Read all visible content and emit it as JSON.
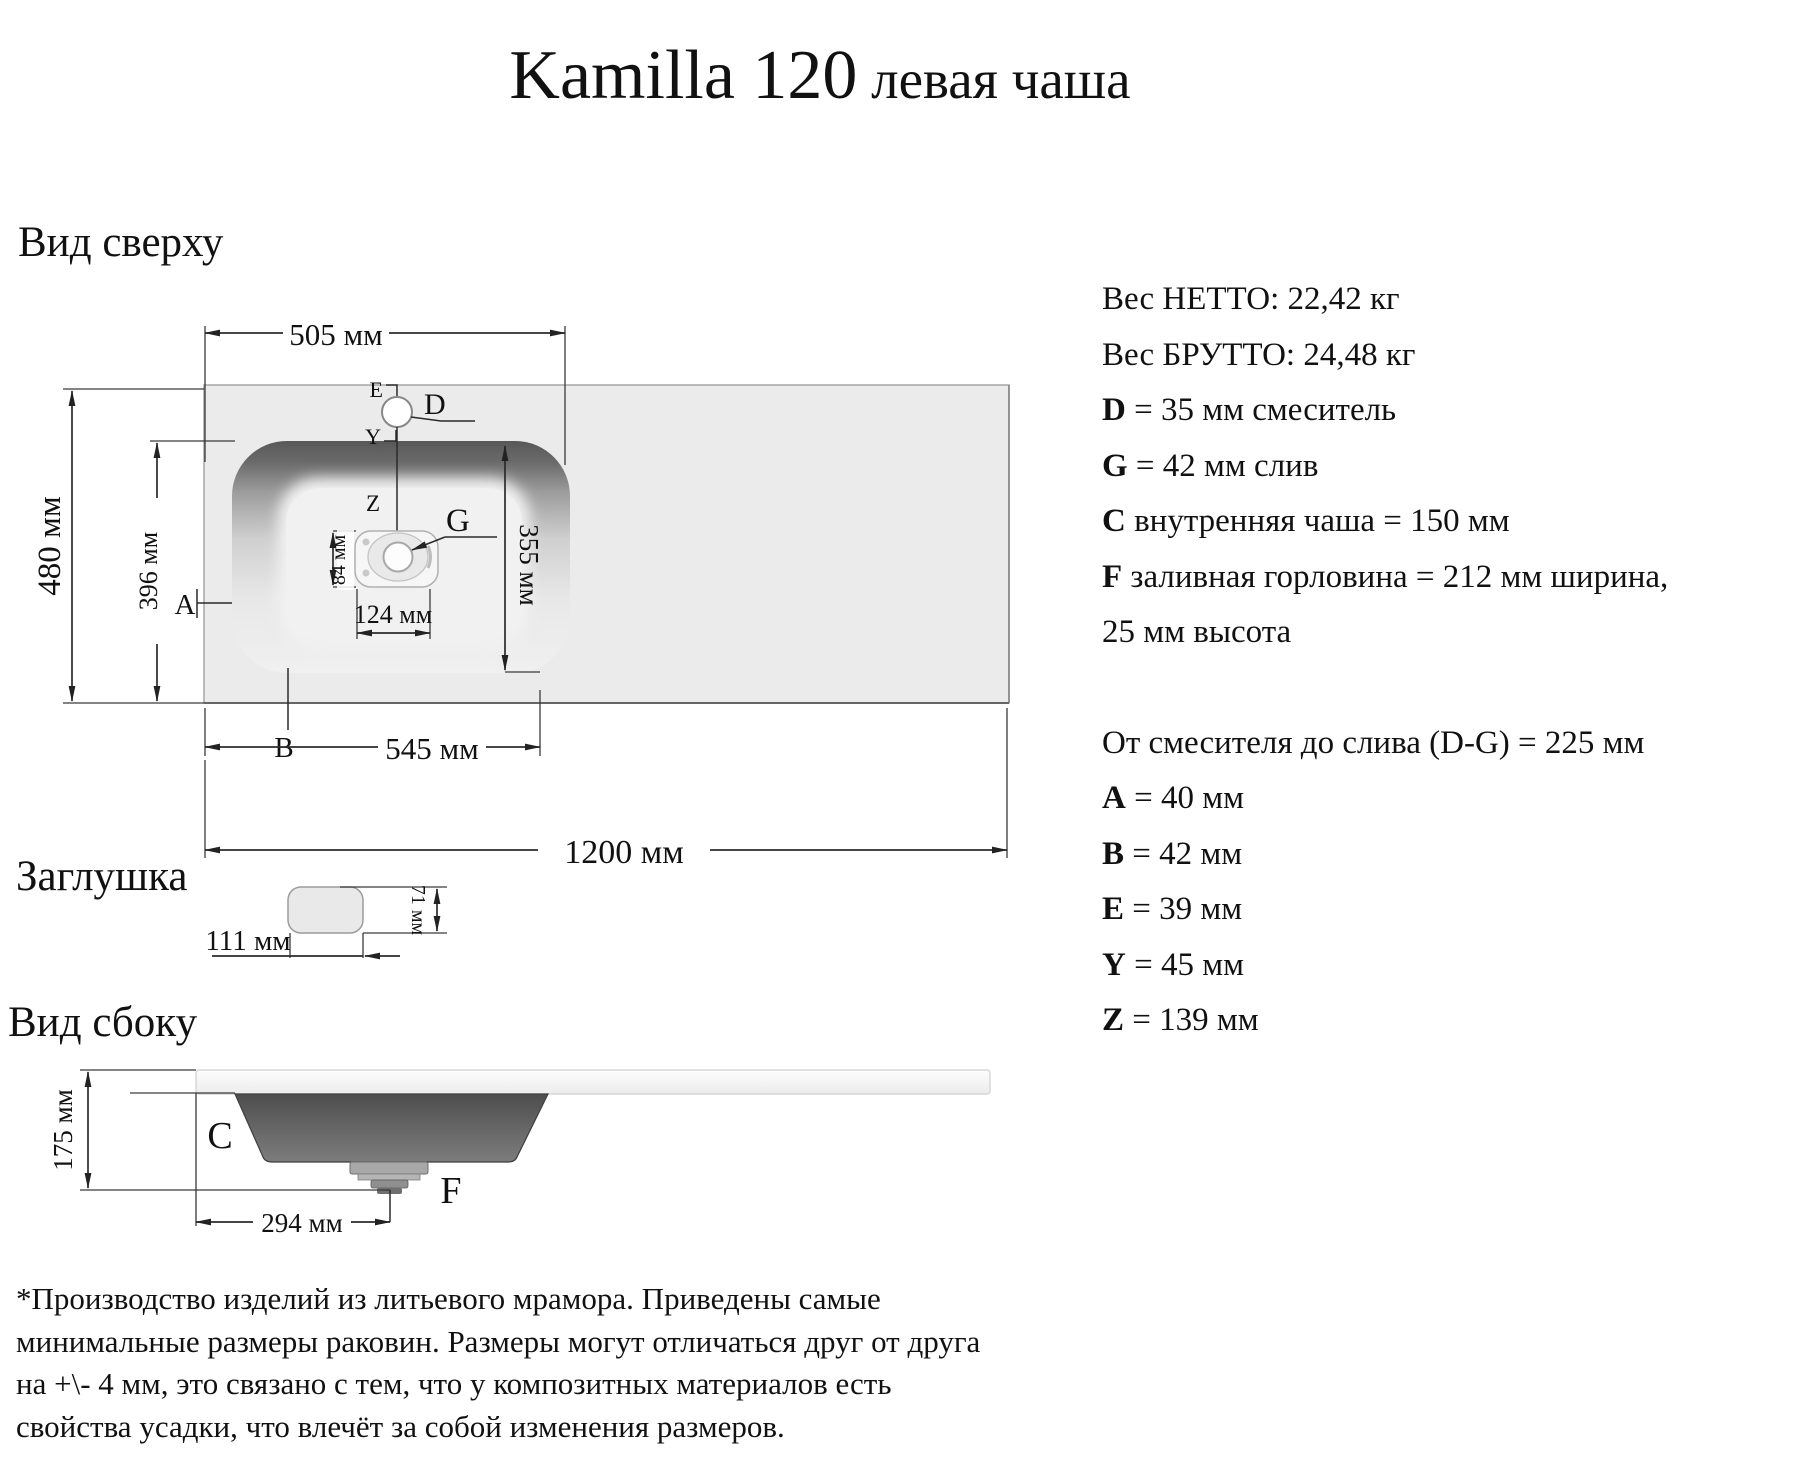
{
  "title": {
    "main": "Kamilla 120",
    "sub": " левая чаша"
  },
  "sections": {
    "top_view": "Вид сверху",
    "plug": "Заглушка",
    "side_view": "Вид сбоку"
  },
  "top_view": {
    "dim_505": "505 мм",
    "dim_480": "480 мм",
    "dim_396": "396 мм",
    "dim_355": "355 мм",
    "dim_84": "84 мм",
    "dim_124": "124 мм",
    "dim_545": "545 мм",
    "dim_1200": "1200 мм",
    "label_a": "A",
    "label_b": "B",
    "label_d": "D",
    "label_e": "E",
    "label_y": "Y",
    "label_z": "Z",
    "label_g": "G"
  },
  "plug": {
    "dim_width": "111 мм",
    "dim_height": "71 мм"
  },
  "side_view": {
    "dim_175": "175 мм",
    "dim_294": "294 мм",
    "label_c": "C",
    "label_f": "F"
  },
  "specs": [
    {
      "prefix": "",
      "rest": "Вес НЕТТО: 22,42 кг"
    },
    {
      "prefix": "",
      "rest": "Вес БРУТТО: 24,48 кг"
    },
    {
      "prefix": "D",
      "rest": " = 35 мм смеситель"
    },
    {
      "prefix": "G",
      "rest": " = 42 мм слив"
    },
    {
      "prefix": "C",
      "rest": " внутренняя чаша = 150 мм"
    },
    {
      "prefix": "F",
      "rest": " заливная горловина = 212 мм ширина,"
    },
    {
      "prefix": "",
      "rest": "25 мм высота"
    },
    {
      "prefix": "",
      "rest": "От смесителя до слива (D-G) = 225 мм"
    },
    {
      "prefix": "A",
      "rest": " = 40 мм"
    },
    {
      "prefix": "B",
      "rest": " = 42 мм"
    },
    {
      "prefix": "E",
      "rest": " = 39 мм"
    },
    {
      "prefix": "Y",
      "rest": " = 45 мм"
    },
    {
      "prefix": "Z",
      "rest": " = 139 мм"
    }
  ],
  "footnote": [
    "*Производство изделий из литьевого мрамора. Приведены самые",
    "минимальные размеры раковин. Размеры могут отличаться друг от друга",
    "на +\\- 4 мм, это связано с тем, что у композитных материалов есть",
    "свойства усадки, что влечёт за собой изменения размеров."
  ]
}
